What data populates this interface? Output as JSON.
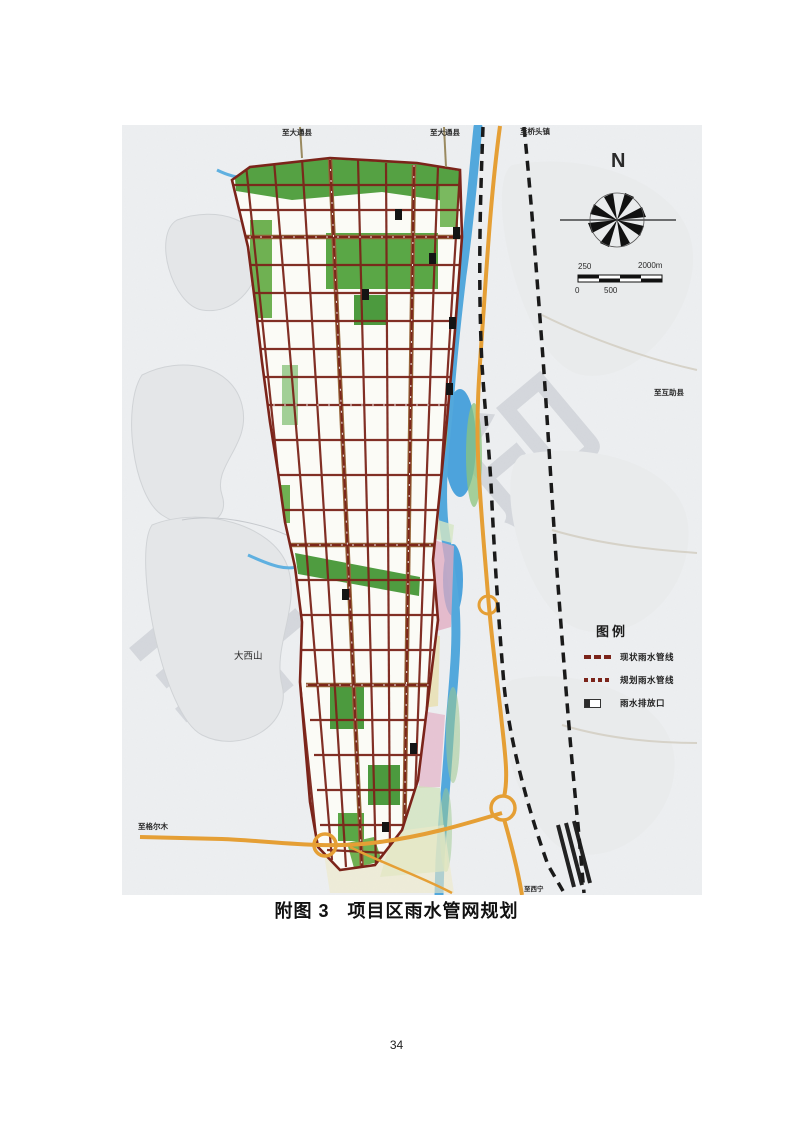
{
  "caption": {
    "figure_no": "附图 3",
    "title": "项目区雨水管网规划"
  },
  "page": {
    "number": "34"
  },
  "map": {
    "labels": {
      "top_left_road": "至大通县",
      "top_mid_road": "至大通县",
      "top_right_road": "至桥头镇",
      "right_road": "至互助县",
      "mountain": "大西山",
      "bottom_left_road": "至格尔木",
      "bottom_right_road": "至西宁"
    },
    "north_arrow": {
      "label": "N"
    },
    "scale_bar": {
      "upper_left": "250",
      "upper_right": "2000m",
      "lower_left": "0",
      "lower_mid": "500"
    },
    "legend": {
      "title": "图例",
      "items": [
        {
          "symbol": "existing-pipe-dash",
          "label": "现状雨水管线"
        },
        {
          "symbol": "planned-pipe-dash",
          "label": "规划雨水管线"
        },
        {
          "symbol": "outfall-box",
          "label": "雨水排放口"
        }
      ]
    },
    "watermark": {
      "char_1": "非",
      "char_2": "印"
    },
    "colors": {
      "road_pipe": "#7b241a",
      "arterial": "#96653a",
      "highway": "#e59f35",
      "river": "#4da3dc",
      "park_green": "#55a143",
      "zone_pink": "#e2a9c0",
      "zone_yellow": "#e8dfae",
      "railway": "#1a1a1a",
      "paper": "#eef0f2"
    }
  }
}
